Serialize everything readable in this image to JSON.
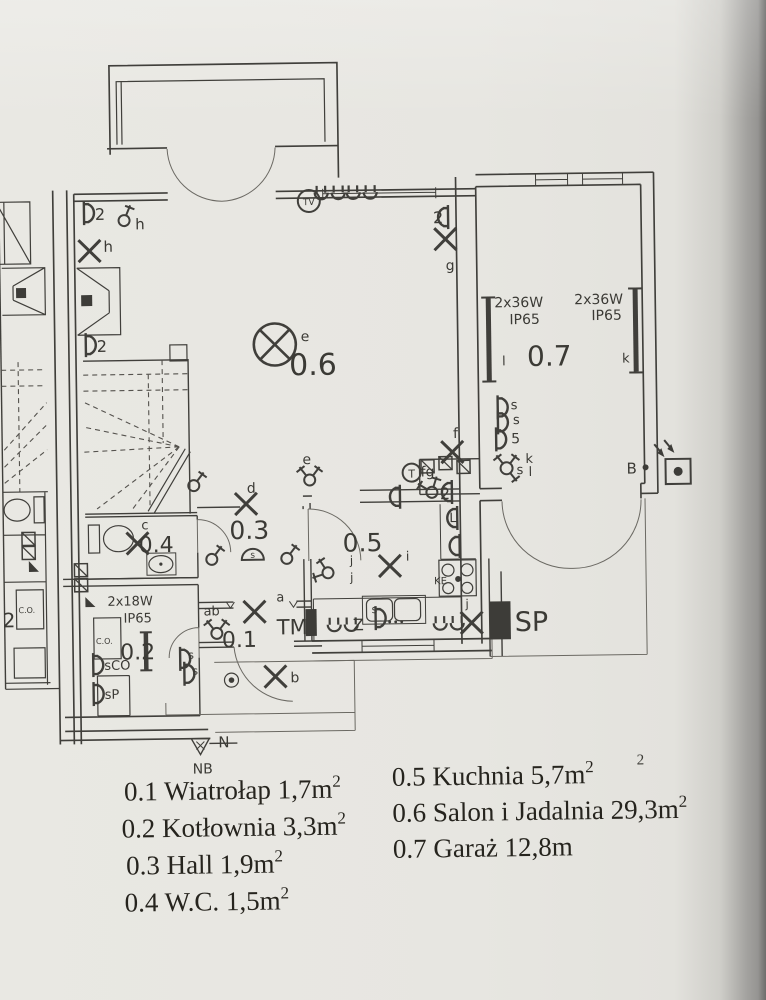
{
  "meta": {
    "description": "Photographed architectural electrical floor plan, ground floor of a semi-detached house (Polish labels)"
  },
  "colors": {
    "paper": "#e7e6e1",
    "line": "#403f3b",
    "label": "#3b3a35",
    "dim": "#7c7971",
    "legend_text": "#26241e",
    "photo_edge": "#8c8b89"
  },
  "plan": {
    "labels": [
      {
        "name": "socket-count-top",
        "t": "2",
        "x": 99,
        "y": 216,
        "s": 16
      },
      {
        "name": "pendant-label-h",
        "t": "h",
        "x": 139,
        "y": 226,
        "s": 15
      },
      {
        "name": "lamp-label-h",
        "t": "h",
        "x": 107,
        "y": 248,
        "s": 15
      },
      {
        "name": "socket-count-mid",
        "t": "2",
        "x": 99,
        "y": 348,
        "s": 16
      },
      {
        "name": "lamp-label-e",
        "t": "e",
        "x": 303,
        "y": 340,
        "s": 14
      },
      {
        "name": "room-number-06",
        "t": "0.6",
        "x": 291,
        "y": 374,
        "s": 30,
        "fill": "dim"
      },
      {
        "name": "tv-outlet-label",
        "t": "TV",
        "x": 313,
        "y": 204,
        "s": 9,
        "anchor": "middle"
      },
      {
        "name": "socket-count-g",
        "t": "2",
        "x": 437,
        "y": 224,
        "s": 16
      },
      {
        "name": "lamp-label-g",
        "t": "g",
        "x": 449,
        "y": 271,
        "s": 14
      },
      {
        "name": "garage-lamp1-spec1",
        "t": "2x36W",
        "x": 497,
        "y": 309,
        "s": 14
      },
      {
        "name": "garage-lamp1-spec2",
        "t": "IP65",
        "x": 512,
        "y": 326,
        "s": 14
      },
      {
        "name": "garage-lamp1-circuit",
        "t": "l",
        "x": 504,
        "y": 367,
        "s": 13
      },
      {
        "name": "room-number-07",
        "t": "0.7",
        "x": 529,
        "y": 368,
        "s": 28,
        "fill": "dim"
      },
      {
        "name": "garage-lamp2-spec1",
        "t": "2x36W",
        "x": 577,
        "y": 307,
        "s": 14
      },
      {
        "name": "garage-lamp2-spec2",
        "t": "IP65",
        "x": 594,
        "y": 323,
        "s": 14
      },
      {
        "name": "garage-lamp2-circuit",
        "t": "k",
        "x": 624,
        "y": 366,
        "s": 13
      },
      {
        "name": "lamp-label-f",
        "t": "f",
        "x": 454,
        "y": 439,
        "s": 14
      },
      {
        "name": "switch-label-fg",
        "t": "fg",
        "x": 421,
        "y": 477,
        "s": 14
      },
      {
        "name": "socket-count-fg",
        "t": "2",
        "x": 440,
        "y": 500,
        "s": 16
      },
      {
        "name": "garage-socket-label-s1",
        "t": "s",
        "x": 512,
        "y": 411,
        "s": 13
      },
      {
        "name": "garage-socket-label-s2",
        "t": "s",
        "x": 514,
        "y": 426,
        "s": 13
      },
      {
        "name": "garage-socket-label-5",
        "t": "5",
        "x": 512,
        "y": 445,
        "s": 14
      },
      {
        "name": "garage-switch-label-s",
        "t": "s",
        "x": 517,
        "y": 476,
        "s": 13
      },
      {
        "name": "garage-switch-label-k",
        "t": "k",
        "x": 526,
        "y": 465,
        "s": 13
      },
      {
        "name": "garage-switch-label-l",
        "t": "l",
        "x": 529,
        "y": 478,
        "s": 13
      },
      {
        "name": "garage-b-label",
        "t": "B",
        "x": 627,
        "y": 477,
        "s": 15
      },
      {
        "name": "thermostat-label",
        "t": "T",
        "x": 412,
        "y": 478,
        "s": 11,
        "anchor": "middle"
      },
      {
        "name": "kitchen-socket-label-L",
        "t": "L",
        "x": 449,
        "y": 523,
        "s": 13
      },
      {
        "name": "switch-label-e",
        "t": "e",
        "x": 303,
        "y": 463,
        "s": 14
      },
      {
        "name": "lamp-label-d",
        "t": "d",
        "x": 247,
        "y": 491,
        "s": 14
      },
      {
        "name": "room-number-03",
        "t": "0.3",
        "x": 229,
        "y": 537,
        "s": 25,
        "fill": "dim"
      },
      {
        "name": "bell-label",
        "t": "s",
        "x": 252,
        "y": 556,
        "s": 9,
        "anchor": "middle"
      },
      {
        "name": "lamp-label-c",
        "t": "c",
        "x": 141,
        "y": 526,
        "s": 13
      },
      {
        "name": "room-number-04",
        "t": "0.4",
        "x": 138,
        "y": 549,
        "s": 22,
        "fill": "dim"
      },
      {
        "name": "room-number-05",
        "t": "0.5",
        "x": 342,
        "y": 551,
        "s": 25,
        "fill": "dim"
      },
      {
        "name": "lamp-label-i",
        "t": "i",
        "x": 405,
        "y": 561,
        "s": 13
      },
      {
        "name": "switch-label-j1",
        "t": "j",
        "x": 349,
        "y": 564,
        "s": 12
      },
      {
        "name": "switch-label-j2",
        "t": "j",
        "x": 349,
        "y": 581,
        "s": 12
      },
      {
        "name": "cooktop-label",
        "t": "KE",
        "x": 433,
        "y": 585,
        "s": 10
      },
      {
        "name": "sink-label",
        "t": "Z",
        "x": 351,
        "y": 630,
        "s": 16
      },
      {
        "name": "sink-switch-label",
        "t": "s",
        "x": 370,
        "y": 613,
        "s": 11
      },
      {
        "name": "lamp-label-j",
        "t": "j",
        "x": 464,
        "y": 609,
        "s": 12
      },
      {
        "name": "sp-label",
        "t": "SP",
        "x": 513,
        "y": 633,
        "s": 27
      },
      {
        "name": "tm-label",
        "t": "TM",
        "x": 275,
        "y": 633,
        "s": 21
      },
      {
        "name": "lamp-label-a",
        "t": "a",
        "x": 275,
        "y": 600,
        "s": 13
      },
      {
        "name": "switch-label-ab",
        "t": "ab",
        "x": 202,
        "y": 613,
        "s": 13
      },
      {
        "name": "room-number-01",
        "t": "0.1",
        "x": 220,
        "y": 645,
        "s": 22,
        "fill": "dim"
      },
      {
        "name": "lamp-label-b",
        "t": "b",
        "x": 288,
        "y": 681,
        "s": 14
      },
      {
        "name": "boiler-lamp-spec1",
        "t": "2x18W",
        "x": 106,
        "y": 602,
        "s": 13
      },
      {
        "name": "boiler-lamp-spec2",
        "t": "IP65",
        "x": 122,
        "y": 619,
        "s": 13
      },
      {
        "name": "co-box-label",
        "t": "C.O.",
        "x": 94,
        "y": 640,
        "s": 8
      },
      {
        "name": "room-number-02",
        "t": "0.2",
        "x": 118,
        "y": 656,
        "s": 22,
        "fill": "dim"
      },
      {
        "name": "socket-label-sco",
        "t": "sCO",
        "x": 102,
        "y": 666,
        "s": 13
      },
      {
        "name": "socket-label-sp",
        "t": "sP",
        "x": 102,
        "y": 695,
        "s": 13
      },
      {
        "name": "socket-label-s-a",
        "t": "s",
        "x": 186,
        "y": 656,
        "s": 11
      },
      {
        "name": "socket-label-s-b",
        "t": "s",
        "x": 190,
        "y": 672,
        "s": 11
      },
      {
        "name": "north-label",
        "t": "N",
        "x": 215,
        "y": 745,
        "s": 15
      },
      {
        "name": "nb-label",
        "t": "NB",
        "x": 189,
        "y": 771,
        "s": 14
      },
      {
        "name": "neighbor-room-number",
        "t": "2",
        "x": 1,
        "y": 622,
        "s": 20,
        "fill": "dim"
      },
      {
        "name": "neighbor-co-label",
        "t": "C.O.",
        "x": 17,
        "y": 608,
        "s": 8
      },
      {
        "name": "legend-stray-sup",
        "t": "2",
        "x": 633,
        "y": 768,
        "s": 15,
        "serif": true
      }
    ],
    "symbols": [
      {
        "type": "lampx",
        "name": "wall-lamp-h",
        "x": 93,
        "y": 247
      },
      {
        "type": "lampx",
        "name": "wall-lamp-g",
        "x": 449,
        "y": 240
      },
      {
        "type": "lampx",
        "name": "wall-lamp-f",
        "x": 453,
        "y": 453
      },
      {
        "type": "lampx",
        "name": "hall-lamp-d",
        "x": 246,
        "y": 502
      },
      {
        "type": "lampx",
        "name": "entry-lamp-a",
        "x": 253,
        "y": 610
      },
      {
        "type": "lampx",
        "name": "outdoor-lamp-b",
        "x": 273,
        "y": 675
      },
      {
        "type": "lampx",
        "name": "wc-lamp-c",
        "x": 137,
        "y": 540
      },
      {
        "type": "lampx",
        "name": "kitchen-lamp-i",
        "x": 389,
        "y": 566
      },
      {
        "type": "lampx",
        "name": "kitchen-lamp-j",
        "x": 470,
        "y": 624
      },
      {
        "type": "ceil",
        "name": "ceiling-lamp-e",
        "x": 277,
        "y": 343
      },
      {
        "type": "sock",
        "name": "double-socket-top",
        "x": 88,
        "y": 209,
        "rot": 0
      },
      {
        "type": "sock",
        "name": "double-socket-mid",
        "x": 88,
        "y": 341,
        "rot": 0
      },
      {
        "type": "sock",
        "name": "double-socket-g",
        "x": 452,
        "y": 218,
        "rot": 180
      },
      {
        "type": "sock",
        "name": "double-socket-fg",
        "x": 452,
        "y": 493,
        "rot": 180
      },
      {
        "type": "sock",
        "name": "garage-socket-s1",
        "x": 499,
        "y": 409,
        "rot": 0
      },
      {
        "type": "sock",
        "name": "garage-socket-s2",
        "x": 499,
        "y": 424,
        "rot": 0
      },
      {
        "type": "sock",
        "name": "garage-socket-5",
        "x": 497,
        "y": 441,
        "rot": 0
      },
      {
        "type": "sock",
        "name": "boiler-socket-sco",
        "x": 91,
        "y": 661,
        "rot": 0
      },
      {
        "type": "sock",
        "name": "boiler-socket-sp",
        "x": 91,
        "y": 690,
        "rot": 0
      },
      {
        "type": "sock",
        "name": "entry-socket-s1",
        "x": 178,
        "y": 656,
        "rot": 0
      },
      {
        "type": "sock",
        "name": "entry-socket-s2",
        "x": 182,
        "y": 671,
        "rot": 0
      },
      {
        "type": "sock",
        "name": "kitchen-socket-L",
        "x": 457,
        "y": 519,
        "rot": 180
      },
      {
        "type": "sock",
        "name": "kitchen-socket-2",
        "x": 459,
        "y": 547,
        "rot": 180
      },
      {
        "type": "sock",
        "name": "kitchen-socket-top",
        "x": 400,
        "y": 497,
        "rot": 180
      },
      {
        "type": "sock",
        "name": "sink-socket-s",
        "x": 374,
        "y": 618,
        "rot": 0
      },
      {
        "type": "uu",
        "name": "tv-under-window-socket-1",
        "x": 334,
        "y": 194
      },
      {
        "type": "uu",
        "name": "tv-under-window-socket-2",
        "x": 366,
        "y": 194
      },
      {
        "type": "uu",
        "name": "kitchen-under-window-socket-1",
        "x": 341,
        "y": 626
      },
      {
        "type": "uu",
        "name": "kitchen-under-window-socket-2",
        "x": 447,
        "y": 626
      },
      {
        "type": "sw1",
        "name": "pendant-switch-h",
        "x": 128,
        "y": 217,
        "rot": -15
      },
      {
        "type": "sw1",
        "name": "stairs-switch",
        "x": 194,
        "y": 483,
        "rot": 0
      },
      {
        "type": "sw1",
        "name": "hall-switch-left",
        "x": 211,
        "y": 557,
        "rot": 0
      },
      {
        "type": "sw1",
        "name": "hall-switch-right",
        "x": 286,
        "y": 557,
        "rot": 0
      },
      {
        "type": "sw2",
        "name": "switch-e",
        "x": 310,
        "y": 479,
        "rot": 0
      },
      {
        "type": "sw2",
        "name": "switch-ab",
        "x": 215,
        "y": 631,
        "rot": 0
      },
      {
        "type": "sw2",
        "name": "switch-fg",
        "x": 432,
        "y": 493,
        "rot": -20
      },
      {
        "type": "sw3",
        "name": "garage-switch-skl",
        "x": 507,
        "y": 470,
        "rot": 0
      },
      {
        "type": "sw2",
        "name": "kitchen-switch-j",
        "x": 327,
        "y": 572,
        "rot": -70
      },
      {
        "type": "xbox",
        "name": "junction-box-1",
        "x": 428,
        "y": 467
      },
      {
        "type": "xbox",
        "name": "junction-box-2",
        "x": 446,
        "y": 464
      },
      {
        "type": "xbox",
        "name": "junction-box-3",
        "x": 464,
        "y": 468
      },
      {
        "type": "xbox",
        "name": "wall-box-1",
        "x": 80,
        "y": 566
      },
      {
        "type": "xbox",
        "name": "wall-box-2",
        "x": 80,
        "y": 581
      },
      {
        "type": "xbox",
        "name": "neighbor-wall-box-1",
        "x": 28,
        "y": 534
      },
      {
        "type": "xbox",
        "name": "neighbor-wall-box-2",
        "x": 28,
        "y": 548
      }
    ]
  },
  "legend": {
    "items": [
      {
        "name": "legend-01",
        "text": "0.1 Wiatrołap  1,7m",
        "sup": "2",
        "x": 120,
        "y": 797
      },
      {
        "name": "legend-05",
        "text": "0.5 Kuchnia  5,7m",
        "sup": "2",
        "x": 388,
        "y": 786
      },
      {
        "name": "legend-02",
        "text": "0.2 Kotłownia  3,3m",
        "sup": "2",
        "x": 117,
        "y": 834
      },
      {
        "name": "legend-06",
        "text": "0.6 Salon i Jadalnia  29,3m",
        "sup": "2",
        "x": 388,
        "y": 822
      },
      {
        "name": "legend-03",
        "text": "0.3 Hall  1,9m",
        "sup": "2",
        "x": 121,
        "y": 871
      },
      {
        "name": "legend-07",
        "text": "0.7 Garaż  12,8m",
        "sup": "",
        "x": 388,
        "y": 858
      },
      {
        "name": "legend-04",
        "text": "0.4 W.C.  1,5m",
        "sup": "2",
        "x": 119,
        "y": 908
      }
    ],
    "font_size": 27,
    "sup_size": 17
  }
}
